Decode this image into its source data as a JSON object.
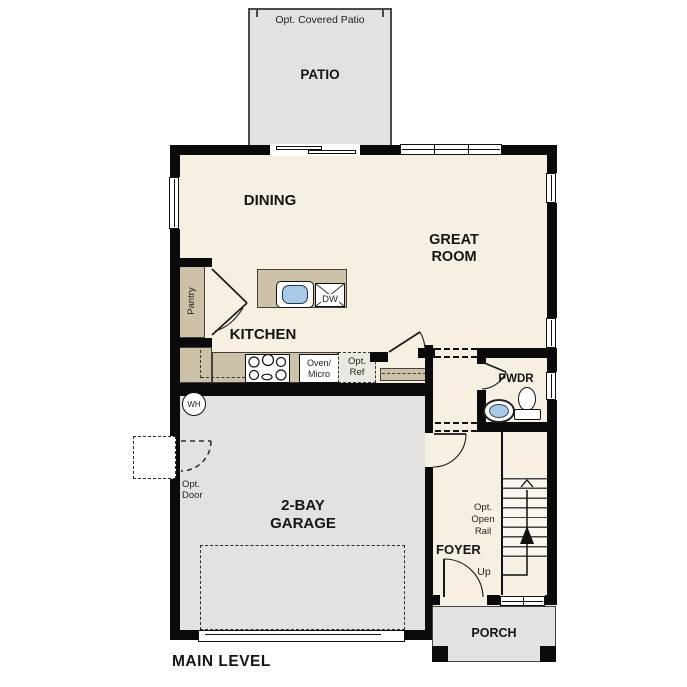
{
  "plan": {
    "title": "MAIN LEVEL"
  },
  "colors": {
    "floor": "#f7efe1",
    "concrete": "#e3e2e0",
    "counter": "#cdc1a7",
    "wall": "#0a0a0a",
    "sink_blue": "#a9c9e9",
    "outline": "#4a4a4a"
  },
  "rooms": {
    "patio": {
      "optional_label": "Opt. Covered Patio",
      "label": "PATIO"
    },
    "dining": {
      "label": "DINING"
    },
    "great_room": {
      "line1": "GREAT",
      "line2": "ROOM"
    },
    "kitchen": {
      "label": "KITCHEN"
    },
    "pantry": {
      "label": "Pantry"
    },
    "pwdr": {
      "label": "PWDR"
    },
    "garage": {
      "line1": "2-BAY",
      "line2": "GARAGE"
    },
    "foyer": {
      "label": "FOYER"
    },
    "porch": {
      "label": "PORCH"
    }
  },
  "fixtures": {
    "dishwasher": {
      "label": "DW"
    },
    "oven_micro": {
      "line1": "Oven/",
      "line2": "Micro"
    },
    "opt_ref": {
      "line1": "Opt.",
      "line2": "Ref"
    },
    "water_heater": {
      "label": "WH"
    },
    "opt_door": {
      "line1": "Opt.",
      "line2": "Door"
    },
    "opt_open_rail": {
      "line1": "Opt.",
      "line2": "Open",
      "line3": "Rail"
    },
    "stairs": {
      "up_label": "Up"
    }
  }
}
